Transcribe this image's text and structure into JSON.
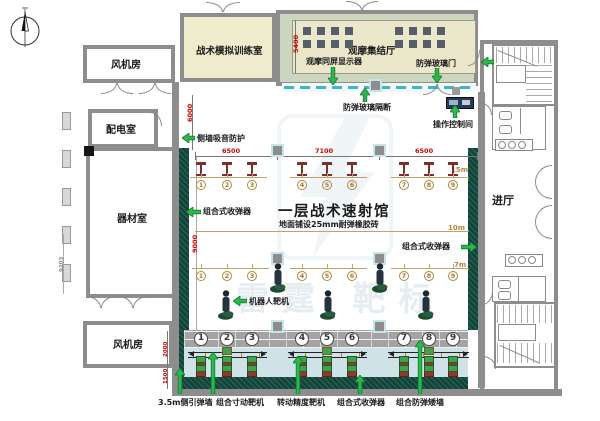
{
  "drawing": {
    "rooms": {
      "fan_room_top": "风机房",
      "power_room": "配电室",
      "equipment_room": "器材室",
      "fan_room_bottom": "风机房",
      "tactical_sim_room": "战术模拟训练室",
      "observation_hall": "观摩集结厅",
      "entrance_hall": "进厅"
    },
    "hall": {
      "title": "一层战术速射馆",
      "subtitle": "地面铺设25mm耐弹橡胶砖"
    },
    "annotations": {
      "side_wall_sound": "侧墙吸音防护",
      "observation_display": "观摩同屏显示器",
      "glass_door": "防弹玻璃门",
      "glass_partition": "防弹玻璃隔断",
      "control_room": "操作控制间",
      "collector_left": "组合式收弹器",
      "collector_right": "组合式收弹器",
      "robot_target": "机器人靶机",
      "side_guide_wall": "3.5m侧引弹墙",
      "inch_target": "组合寸动靶机",
      "precision_target": "转动精度靶机",
      "collector_bottom": "组合式收弹器",
      "low_wall": "组合防弹矮墙"
    },
    "dimensions": {
      "top": [
        "6500",
        "7100",
        "6500"
      ],
      "upper_left": "6000",
      "observation": "5400",
      "hall_left": "9000",
      "bottom_left": [
        "2000",
        "1500"
      ],
      "west_wing": "9203"
    },
    "range_marks": [
      "15m",
      "10m",
      "7m"
    ],
    "lanes": [
      "1",
      "2",
      "3",
      "4",
      "5",
      "6",
      "7",
      "8",
      "9"
    ],
    "watermark": "雷霆  靶标",
    "colors": {
      "wall_gray": "#8d8d8d",
      "room_cream": "#eeeccd",
      "room_sage": "#ccd5bd",
      "collector_teal": "#16453c",
      "lane_blue": "#cfe2e8",
      "partition_cyan": "#3fb3cc",
      "dim_red": "#cc0000",
      "range_tan": "#b5853c",
      "arrow_green": "#2db84e"
    }
  }
}
